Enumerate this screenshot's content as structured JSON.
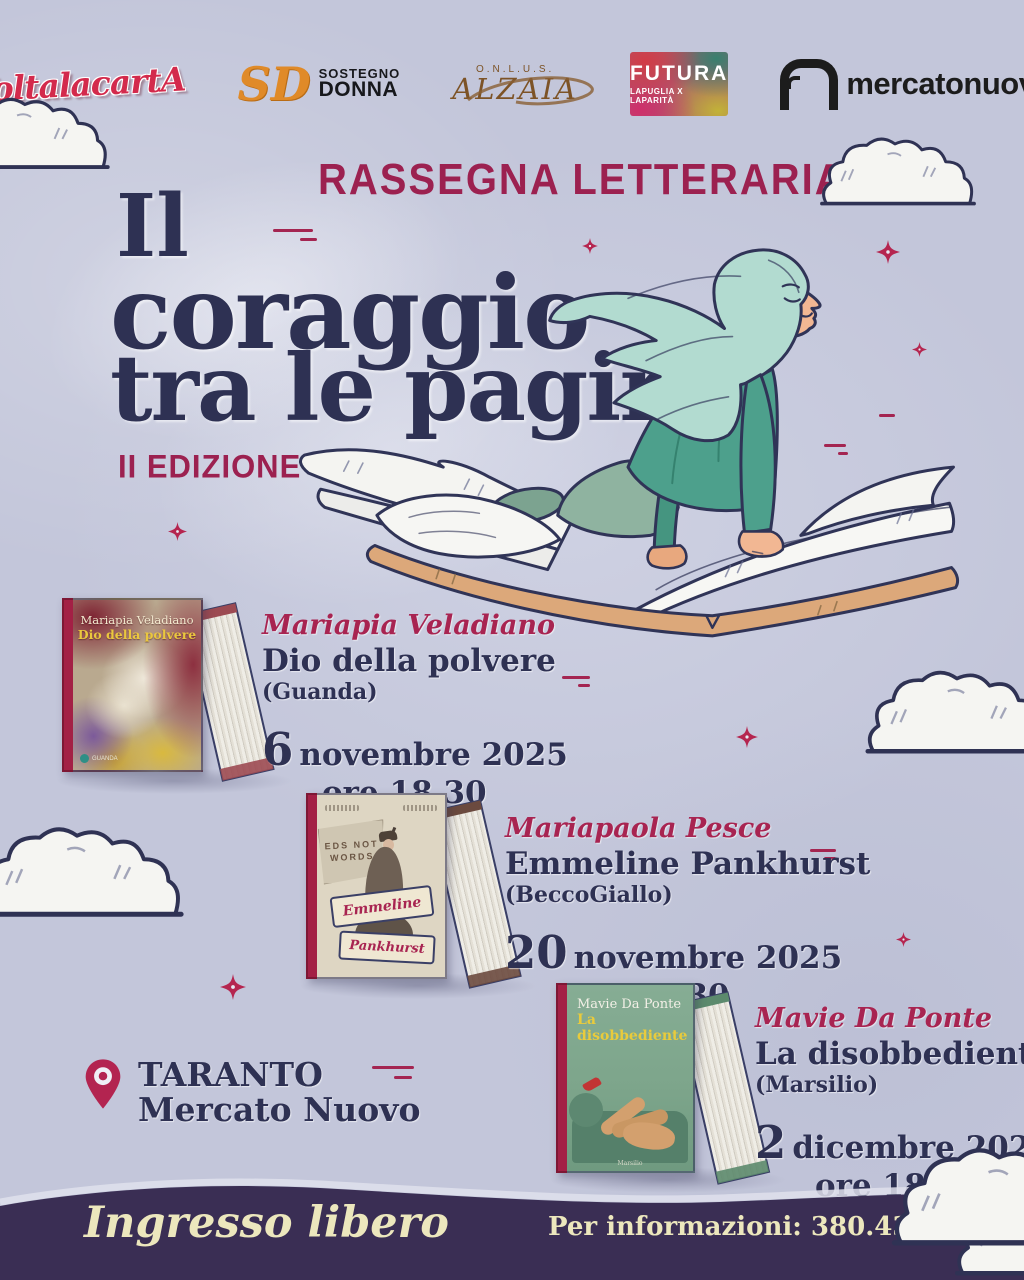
{
  "colors": {
    "background": "#c3c6da",
    "navy": "#2e3153",
    "crimson": "#9c2150",
    "footer_bg": "#3a2e54",
    "footer_text": "#ece7bd",
    "teal": "#4da08c",
    "book_tan": "#dca87a"
  },
  "partners": {
    "voltalacarta": {
      "label": "VoltalacartA"
    },
    "sostegno_donna": {
      "monogram": "SD",
      "line1": "SOSTEGNO",
      "line2": "DONNA"
    },
    "alzaia": {
      "onlus": "O.N.L.U.S.",
      "label": "ALZAIA"
    },
    "futura": {
      "label": "FUTURA",
      "subtitle": "LAPUGLIA X LAPARITÀ"
    },
    "mercatonuovo": {
      "label": "mercatonuovo"
    }
  },
  "header": {
    "kicker": "RASSEGNA LETTERARIA",
    "title_line1": "Il",
    "title_line2": "coraggio",
    "title_line3": "tra le pagine",
    "edition": "II EDIZIONE"
  },
  "events": [
    {
      "author": "Mariapia Veladiano",
      "title": "Dio della polvere",
      "publisher": "(Guanda)",
      "date_number": "6",
      "date_text": "novembre 2025",
      "time": "ore 18.30",
      "cover": {
        "author": "Mariapia Veladiano",
        "title": "Dio della polvere",
        "imprint": "GUANDA"
      }
    },
    {
      "author": "Mariapaola Pesce",
      "title": "Emmeline Pankhurst",
      "publisher": "(BeccoGiallo)",
      "date_number": "20",
      "date_text": "novembre 2025",
      "time": "ore 18.30",
      "cover": {
        "flag_line1": "EDS NOT",
        "flag_line2": "WORDS",
        "banner_line1": "Emmeline",
        "banner_line2": "Pankhurst"
      }
    },
    {
      "author": "Mavie Da Ponte",
      "title": "La disobbediente",
      "publisher": "(Marsilio)",
      "date_number": "2",
      "date_text": "dicembre 2025",
      "time": "ore 18.30",
      "cover": {
        "author": "Mavie Da Ponte",
        "title": "La disobbediente",
        "imprint": "Marsilio"
      }
    }
  ],
  "location": {
    "city": "TARANTO",
    "venue": "Mercato Nuovo"
  },
  "footer": {
    "admission": "Ingresso libero",
    "info": "Per informazioni: 380.4385348"
  }
}
